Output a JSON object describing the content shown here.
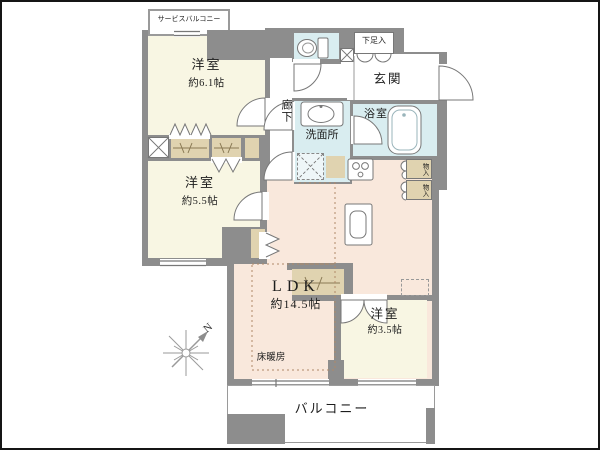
{
  "rooms": {
    "service_balcony": {
      "name": "サービスバルコニー"
    },
    "bedroom1": {
      "name": "洋室",
      "size": "約6.1帖"
    },
    "bedroom2": {
      "name": "洋室",
      "size": "約5.5帖"
    },
    "bedroom3": {
      "name": "洋室",
      "size": "約3.5帖"
    },
    "ldk": {
      "name": "LDK",
      "size": "約14.5帖"
    },
    "corridor": {
      "name": "廊下"
    },
    "entrance": {
      "name": "玄関"
    },
    "shoe_cabinet": {
      "name": "下足入"
    },
    "bathroom": {
      "name": "浴室"
    },
    "washroom": {
      "name": "洗面所"
    },
    "storage_upper": {
      "name": "物入"
    },
    "storage_lower": {
      "name": "物入"
    },
    "floor_heating": {
      "name": "床暖房"
    },
    "balcony": {
      "name": "バルコニー"
    }
  },
  "compass": {
    "north_label": "N"
  },
  "colors": {
    "wall": "#8d8d8d",
    "bedroom_floor": "#f8f6e3",
    "ldk_floor": "#f9e8dc",
    "wet_area_floor": "#d9edf0",
    "closet": "#e0d3b0",
    "outline": "#777777"
  }
}
